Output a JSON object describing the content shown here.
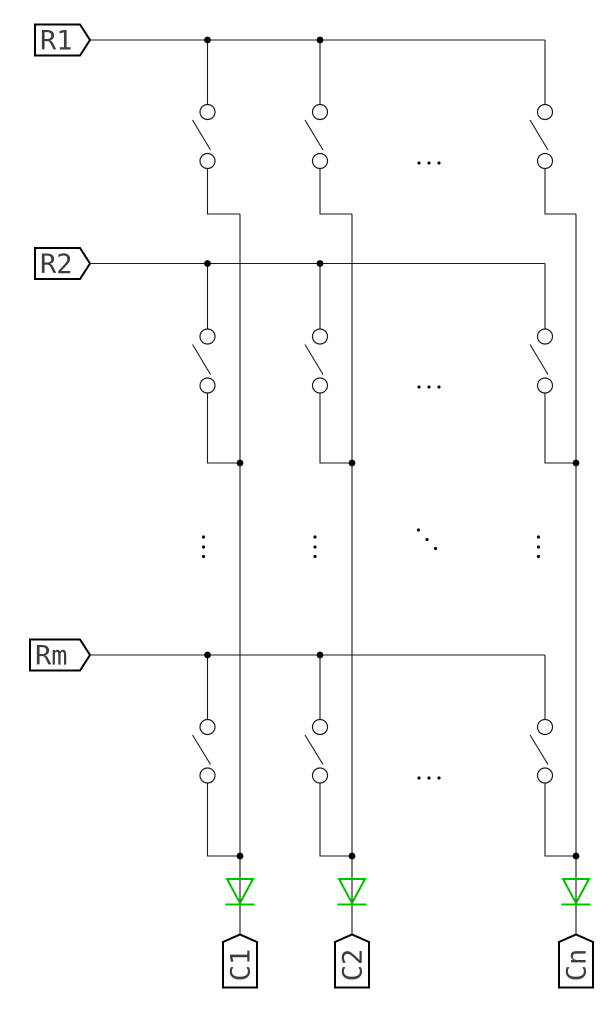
{
  "diagram_title": "keyboard-matrix-schematic",
  "colors": {
    "background": "#ffffff",
    "wire": "#1a1a1a",
    "outline": "#000000",
    "junction": "#000000",
    "diode_green": "#00c000",
    "text": "#3d3d3d"
  },
  "geometry": {
    "canvas": {
      "width": 612,
      "height": 1009
    },
    "row_wire": {
      "x1": 90,
      "x2": 545
    },
    "flag_tip": 10,
    "switch_circle_r": 7.5,
    "diode": {
      "top_y": 879,
      "apex_y": 903,
      "bar_y": 904.5,
      "half_w": 13,
      "bar_half_w": 14.5
    },
    "col_label": {
      "peak_y": 934.5,
      "body_top": 942,
      "bottom": 987.5,
      "half_w": 17,
      "text_cy": 965
    }
  },
  "rows": [
    {
      "label": "R1",
      "wire_y": 40,
      "box": {
        "x": 35,
        "y": 24.5,
        "w": 45,
        "h": 31
      },
      "circle1_y": 112,
      "circle2_y": 161,
      "jog_y": 214,
      "jog_dot": false
    },
    {
      "label": "R2",
      "wire_y": 263.5,
      "box": {
        "x": 35,
        "y": 248,
        "w": 45,
        "h": 31
      },
      "circle1_y": 336.5,
      "circle2_y": 385.5,
      "jog_y": 463,
      "jog_dot": true
    },
    {
      "label": "Rm",
      "wire_y": 655,
      "box": {
        "x": 30,
        "y": 639.5,
        "w": 50,
        "h": 31
      },
      "circle1_y": 727,
      "circle2_y": 775.5,
      "jog_y": 856,
      "jog_dot": true
    }
  ],
  "columns": [
    {
      "label": "C1",
      "switch_x": 207.5,
      "line_x": 240,
      "tap_dot": true
    },
    {
      "label": "C2",
      "switch_x": 320,
      "line_x": 352,
      "tap_dot": true
    },
    {
      "label": "Cn",
      "switch_x": 545,
      "line_x": 576,
      "tap_dot": false
    }
  ],
  "ellipses": {
    "horizontal": [
      {
        "y": 163,
        "xs": [
          419,
          429,
          439
        ]
      },
      {
        "y": 387,
        "xs": [
          419,
          429,
          439
        ]
      },
      {
        "y": 778,
        "xs": [
          419,
          429,
          439
        ]
      }
    ],
    "vertical": [
      {
        "x": 203.5,
        "ys": [
          537,
          547,
          556.5
        ]
      },
      {
        "x": 315,
        "ys": [
          537,
          547,
          556.5
        ]
      },
      {
        "x": 538.5,
        "ys": [
          537,
          547,
          556.5
        ]
      }
    ],
    "diagonal": [
      {
        "x": 418.5,
        "y": 530
      },
      {
        "x": 427,
        "y": 539.5
      },
      {
        "x": 435.5,
        "y": 548.5
      }
    ]
  }
}
